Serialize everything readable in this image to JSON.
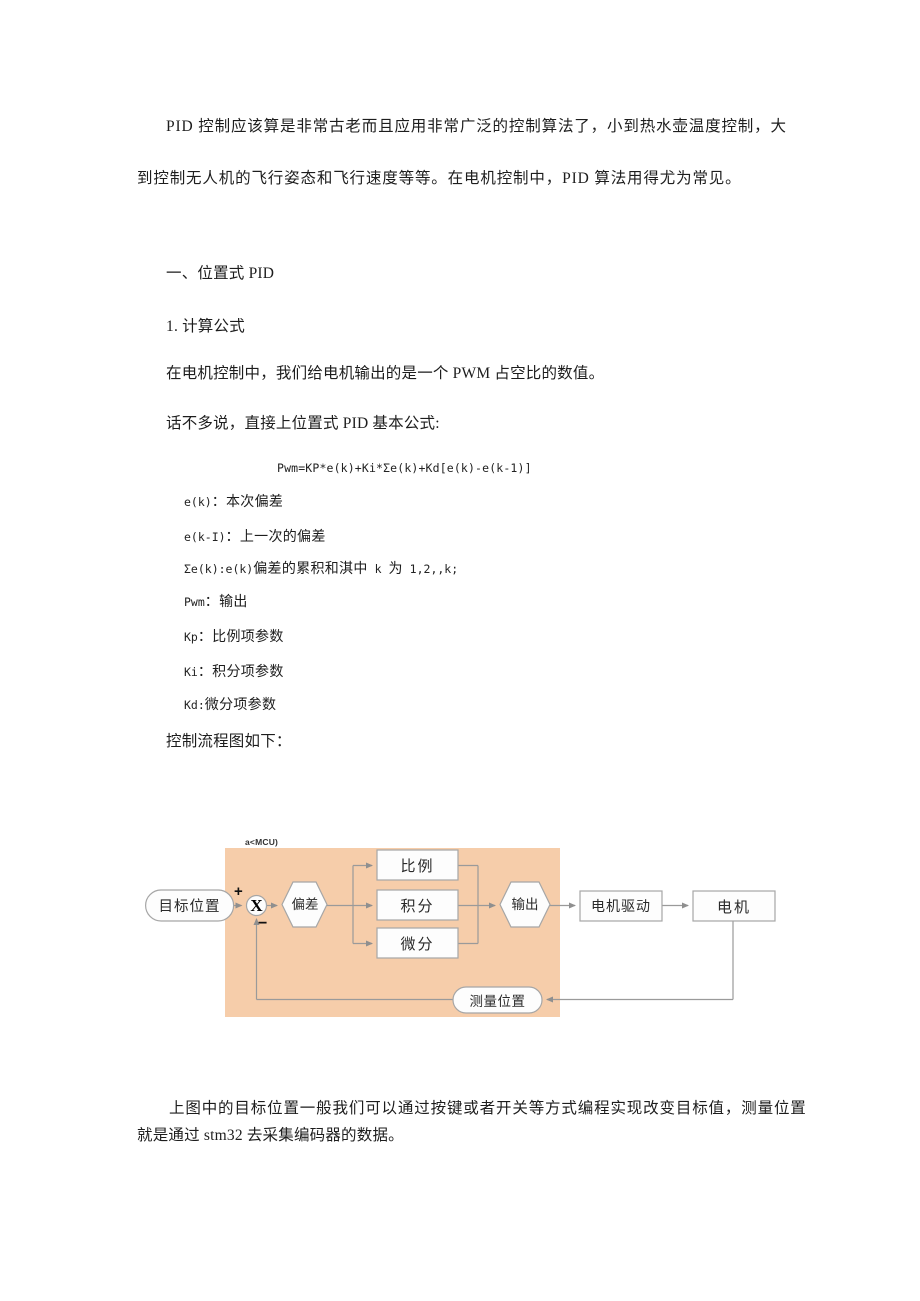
{
  "intro": {
    "line1": "PID 控制应该算是非常古老而且应用非常广泛的控制算法了，小到热水壶温度控制，大",
    "line2": "到控制无人机的飞行姿态和飞行速度等等。在电机控制中，PID 算法用得尤为常见。"
  },
  "headings": {
    "section": "一、位置式 PID",
    "sub": "1. 计算公式"
  },
  "body": {
    "pwm_line": "在电机控制中，我们给电机输出的是一个 PWM 占空比的数值。",
    "formula_intro": "话不多说，直接上位置式 PID 基本公式:",
    "formula": "Pwm=KP*e(k)+Ki*Σe(k)+Kd[e(k)-e(k-1)]",
    "flow_label": "控制流程图如下："
  },
  "defs": [
    [
      {
        "m": 1,
        "s": "e(k)"
      },
      {
        "m": 0,
        "s": "：本次偏差"
      }
    ],
    [
      {
        "m": 1,
        "s": "e(k-I)"
      },
      {
        "m": 0,
        "s": "：上一次的偏差"
      }
    ],
    [
      {
        "m": 1,
        "s": "Σe(k):e(k)"
      },
      {
        "m": 0,
        "s": "偏差的累积和淇中"
      },
      {
        "m": 1,
        "s": " k "
      },
      {
        "m": 0,
        "s": "为"
      },
      {
        "m": 1,
        "s": " 1,2,,k;"
      }
    ],
    [
      {
        "m": 1,
        "s": "Pwm"
      },
      {
        "m": 0,
        "s": "：输出"
      }
    ],
    [
      {
        "m": 1,
        "s": "Kp"
      },
      {
        "m": 0,
        "s": "：比例项参数"
      }
    ],
    [
      {
        "m": 1,
        "s": "Ki"
      },
      {
        "m": 0,
        "s": "：积分项参数"
      }
    ],
    [
      {
        "m": 1,
        "s": "Kd:"
      },
      {
        "m": 0,
        "s": "微分项参数"
      }
    ]
  ],
  "diagram": {
    "mcu_label": "a<MCU)",
    "colors": {
      "mcu_bg": "#F6CDAA",
      "shape_fill": "#FDFDFD",
      "shape_border": "#A6A6A6",
      "line": "#979797",
      "text": "#2a2a2a"
    },
    "nodes": {
      "target": "目标位置",
      "sum": "X",
      "plus": "+",
      "minus": "−",
      "error": "偏差",
      "proportional": "比例",
      "integral": "积分",
      "derivative": "微分",
      "output": "输出",
      "driver": "电机驱动",
      "motor": "电机",
      "measure": "测量位置"
    }
  },
  "footer": {
    "line1": "上图中的目标位置一般我们可以通过按键或者开关等方式编程实现改变目标值，测量位置",
    "line2": "就是通过 stm32 去采集编码器的数据。"
  }
}
